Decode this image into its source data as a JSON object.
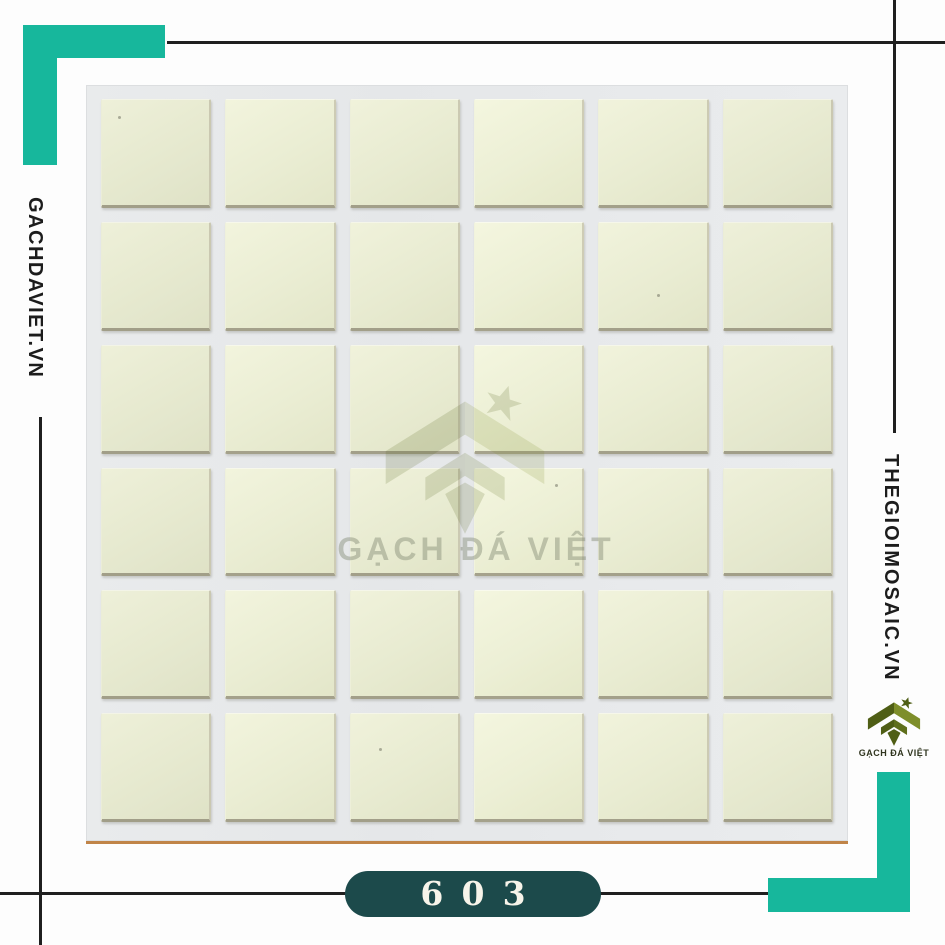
{
  "brand": {
    "left_text": "GACHDAVIET.VN",
    "right_text": "THEGIOIMOSAIC.VN",
    "logo_caption": "GẠCH ĐÁ VIỆT",
    "watermark_text": "GẠCH ĐÁ VIỆT"
  },
  "product": {
    "code": "603"
  },
  "grid": {
    "rows": 6,
    "cols": 6
  },
  "icons": {
    "brand_logo": "gem-diamond-logo",
    "star": "star-icon"
  },
  "colors": {
    "teal": "#17b79c",
    "line": "#1f1f1f",
    "side_text": "#1c1c1c",
    "pill_bg": "#1c4a4b",
    "pill_text": "#f7f4ea",
    "tile": "#e9ecd2",
    "grout": "#e7e9ea",
    "board_edge": "#c08448",
    "logo_dark": "#4f5e15",
    "logo_mid": "#5f6f1c",
    "logo_light": "#7e8e2a",
    "logo_caption_color": "#30351f",
    "watermark": "rgba(125,130,110,0.42)"
  }
}
